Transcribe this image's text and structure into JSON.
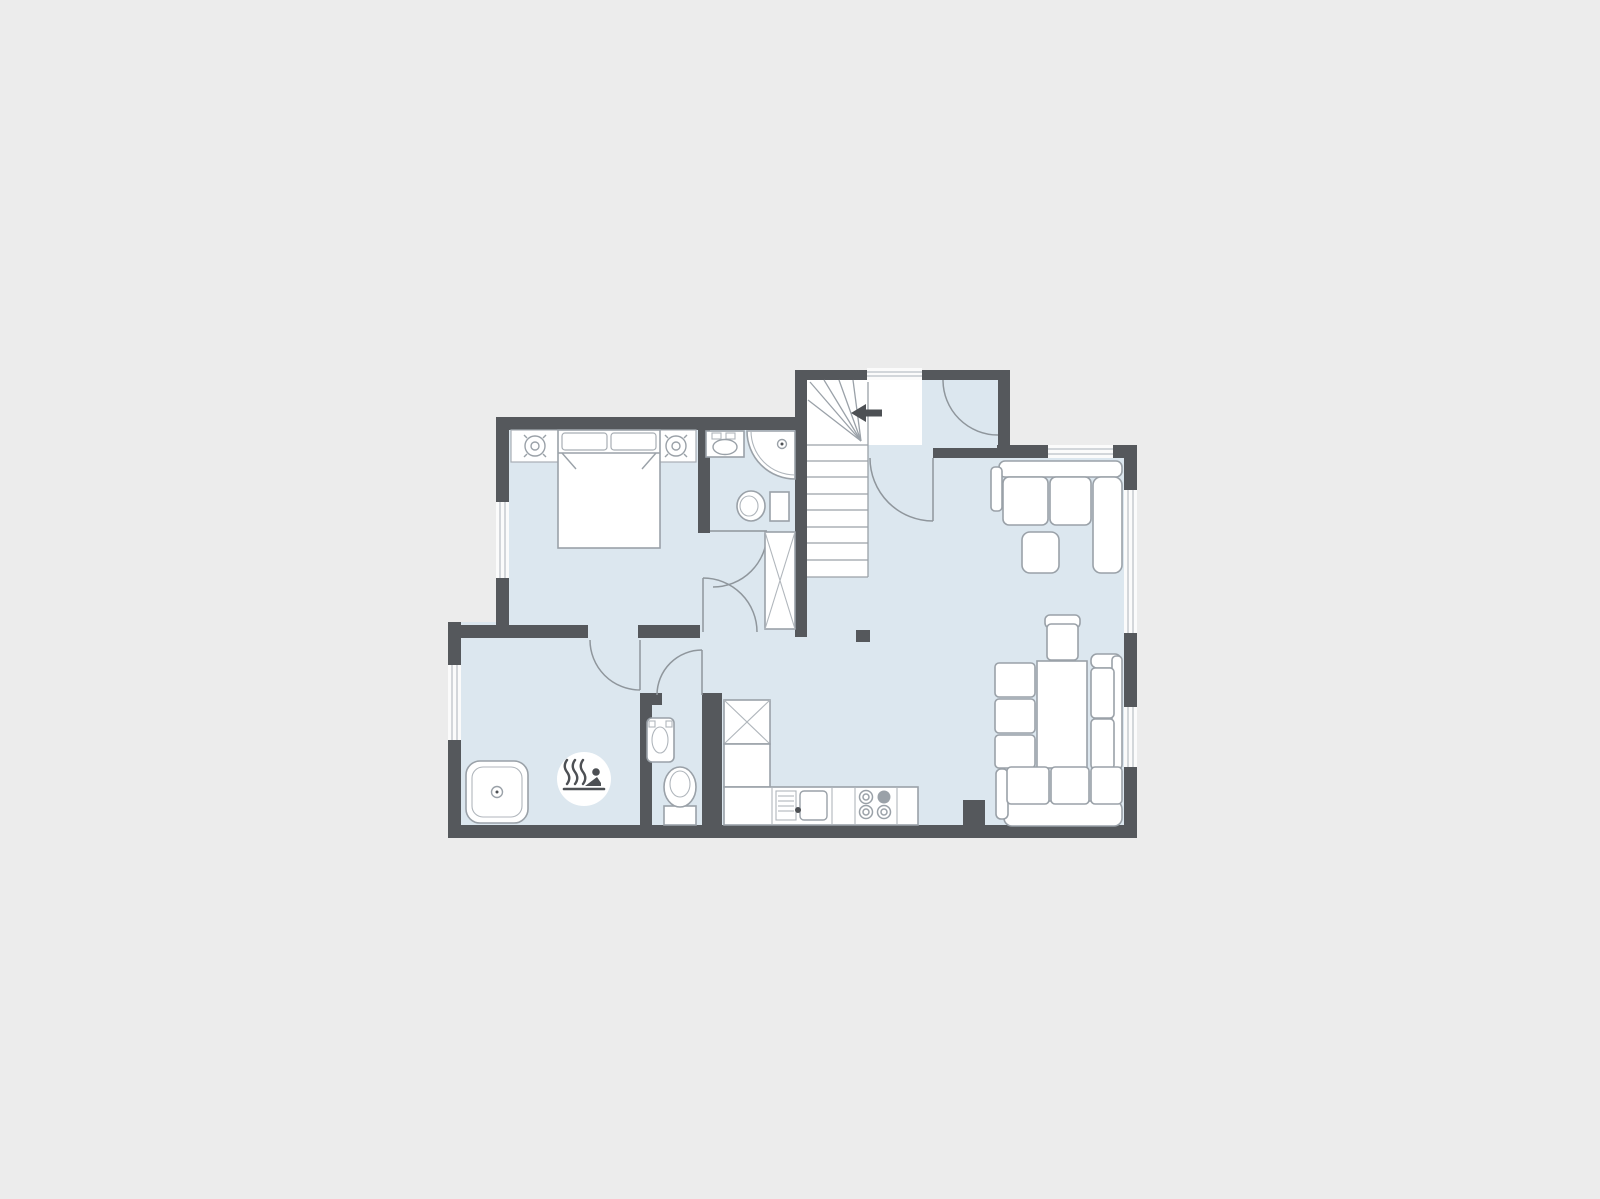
{
  "title": "apartment-floor-plan",
  "colors": {
    "background": "#ececec",
    "floor": "#dce7ef",
    "wall": "#55585c",
    "furniture_fill": "#ffffff",
    "furniture_stroke": "#9aa1a8",
    "door_arc": "#8f969c",
    "window_line": "#b9bfc5",
    "icon_dark": "#4d5054"
  },
  "rooms": [
    {
      "name": "bedroom",
      "position": "top-left"
    },
    {
      "name": "bathroom",
      "position": "top-center"
    },
    {
      "name": "entry-vestibule",
      "position": "top-middle"
    },
    {
      "name": "staircase",
      "position": "center"
    },
    {
      "name": "hallway",
      "position": "center"
    },
    {
      "name": "living-dining-room",
      "position": "right"
    },
    {
      "name": "kitchen",
      "position": "bottom-center"
    },
    {
      "name": "sauna-room",
      "position": "bottom-left"
    },
    {
      "name": "wc",
      "position": "bottom-middle"
    }
  ],
  "furniture": {
    "bedroom": [
      "double-bed",
      "pillow",
      "pillow",
      "headboard-console",
      "ceiling-lamp-symbol",
      "ceiling-lamp-symbol"
    ],
    "bathroom": [
      "washbasin",
      "corner-shower",
      "toilet",
      "wardrobe-closet"
    ],
    "staircase": [
      "winder-stairs",
      "direction-arrow"
    ],
    "living_room": [
      "corner-sofa",
      "ottoman",
      "armchair",
      "bench-seats",
      "table",
      "two-seat-sofa",
      "three-seat-sofa"
    ],
    "kitchen": [
      "tall-cabinet",
      "base-cabinet",
      "counter",
      "sink-with-drainer",
      "stove-4-burners"
    ],
    "sauna_room": [
      "plunge-tub",
      "sauna-sign"
    ],
    "wc": [
      "washbasin",
      "toilet"
    ]
  },
  "icons": [
    {
      "name": "sauna-hot-springs-icon",
      "meaning": "sauna / hot bath"
    },
    {
      "name": "stairs-direction-arrow",
      "direction": "left"
    },
    {
      "name": "ceiling-lamp-icon",
      "count": 2
    }
  ],
  "openings": {
    "windows": 6,
    "doors": 6,
    "door_list": [
      "entry-door",
      "hall-door",
      "bedroom-door",
      "bathroom-door",
      "sauna-door",
      "wc-door"
    ]
  }
}
